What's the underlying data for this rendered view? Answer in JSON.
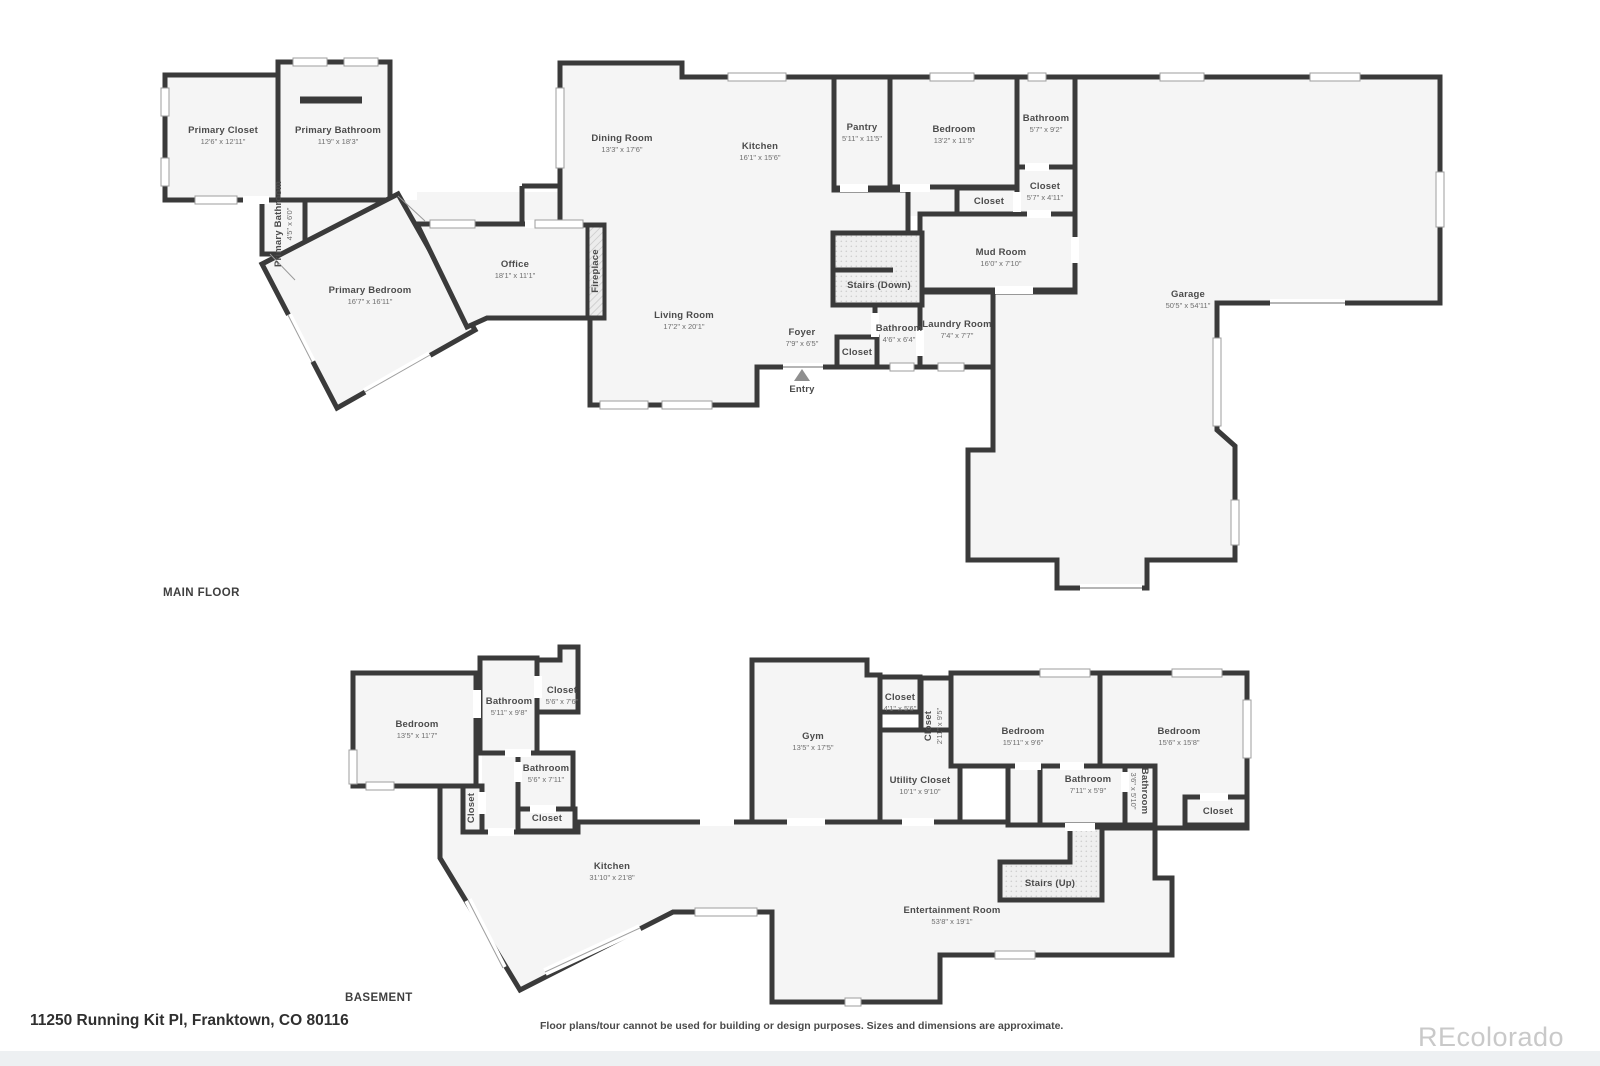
{
  "page": {
    "address": "11250 Running Kit Pl, Franktown, CO 80116",
    "disclaimer": "Floor plans/tour cannot be used for building or design purposes. Sizes and dimensions are approximate.",
    "watermark": "REcolorado"
  },
  "colors": {
    "wall": "#3a3a3a",
    "floor_fill": "#f5f5f5",
    "label": "#4b4b4b",
    "dims": "#6e6e6e",
    "watermark": "#c9c9c9",
    "window": "#ffffff",
    "entry_marker": "#8f8f8f"
  },
  "main_floor": {
    "title": "MAIN FLOOR",
    "rooms": [
      {
        "name": "Primary Closet",
        "dims": "12'6\" x 12'11\""
      },
      {
        "name": "Primary Bathroom",
        "dims": "11'9\" x 18'3\""
      },
      {
        "name": "Primary Bathroom",
        "dims": "4'5\" x 6'0\""
      },
      {
        "name": "Primary Bedroom",
        "dims": "16'7\" x 16'11\""
      },
      {
        "name": "Office",
        "dims": "18'1\" x 11'1\""
      },
      {
        "name": "Fireplace",
        "dims": ""
      },
      {
        "name": "Dining Room",
        "dims": "13'3\" x 17'6\""
      },
      {
        "name": "Kitchen",
        "dims": "16'1\" x 15'6\""
      },
      {
        "name": "Pantry",
        "dims": "5'11\" x 11'5\""
      },
      {
        "name": "Bedroom",
        "dims": "13'2\" x 11'5\""
      },
      {
        "name": "Bathroom",
        "dims": "5'7\" x 9'2\""
      },
      {
        "name": "Closet",
        "dims": "5'7\" x 4'11\""
      },
      {
        "name": "Closet",
        "dims": ""
      },
      {
        "name": "Mud Room",
        "dims": "16'0\" x 7'10\""
      },
      {
        "name": "Stairs (Down)",
        "dims": ""
      },
      {
        "name": "Living Room",
        "dims": "17'2\" x 20'1\""
      },
      {
        "name": "Foyer",
        "dims": "7'9\" x 6'5\""
      },
      {
        "name": "Closet",
        "dims": ""
      },
      {
        "name": "Bathroom",
        "dims": "4'6\" x 6'4\""
      },
      {
        "name": "Laundry Room",
        "dims": "7'4\" x 7'7\""
      },
      {
        "name": "Entry",
        "dims": ""
      },
      {
        "name": "Garage",
        "dims": "50'5\" x 54'11\""
      }
    ]
  },
  "basement": {
    "title": "BASEMENT",
    "rooms": [
      {
        "name": "Bedroom",
        "dims": "13'5\" x 11'7\""
      },
      {
        "name": "Bathroom",
        "dims": "5'11\" x 9'8\""
      },
      {
        "name": "Closet",
        "dims": "5'6\" x 7'6\""
      },
      {
        "name": "Bathroom",
        "dims": "5'6\" x 7'11\""
      },
      {
        "name": "Closet",
        "dims": ""
      },
      {
        "name": "Closet",
        "dims": ""
      },
      {
        "name": "Gym",
        "dims": "13'5\" x 17'5\""
      },
      {
        "name": "Closet",
        "dims": "4'1\" x 5'6\""
      },
      {
        "name": "Closet",
        "dims": "2'11\" x 9'5\""
      },
      {
        "name": "Utility Closet",
        "dims": "10'1\" x 9'10\""
      },
      {
        "name": "Bedroom",
        "dims": "15'11\" x 9'6\""
      },
      {
        "name": "Bedroom",
        "dims": "15'6\" x 15'8\""
      },
      {
        "name": "Bathroom",
        "dims": "7'11\" x 5'9\""
      },
      {
        "name": "Bathroom",
        "dims": "3'6\" x 5'10\""
      },
      {
        "name": "Closet",
        "dims": ""
      },
      {
        "name": "Kitchen",
        "dims": "31'10\" x 21'8\""
      },
      {
        "name": "Stairs (Up)",
        "dims": ""
      },
      {
        "name": "Entertainment Room",
        "dims": "53'8\" x 19'1\""
      }
    ]
  }
}
